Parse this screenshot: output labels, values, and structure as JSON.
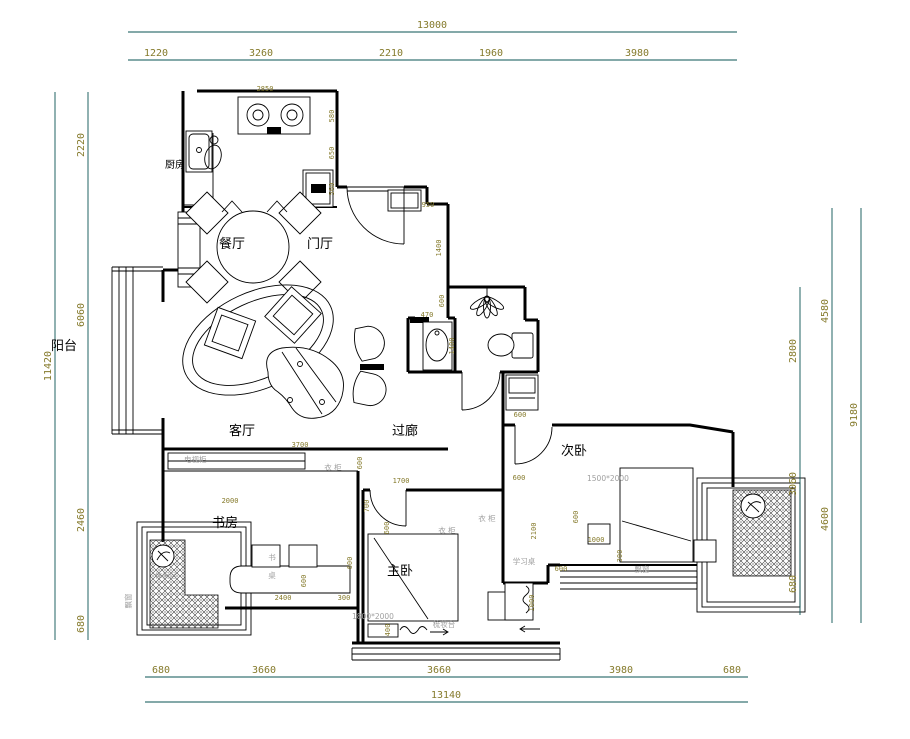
{
  "title": "apartment-floor-plan",
  "colors": {
    "wall": "#000000",
    "dim_line": "#0a5353",
    "dim_text": "#857a2b",
    "tick": "#dd0000",
    "fixture_text": "#a0a0a0"
  },
  "rooms": [
    {
      "label": "厨房"
    },
    {
      "label": "餐厅"
    },
    {
      "label": "门厅"
    },
    {
      "label": "阳台"
    },
    {
      "label": "客厅"
    },
    {
      "label": "过廊"
    },
    {
      "label": "书房"
    },
    {
      "label": "主卧"
    },
    {
      "label": "次卧"
    }
  ],
  "dims": {
    "top": {
      "total": "13000",
      "segments": [
        "1220",
        "3260",
        "2210",
        "1960",
        "3980"
      ]
    },
    "left": {
      "total": "11420",
      "segments": [
        "2220",
        "6060",
        "2460",
        "680"
      ]
    },
    "right": {
      "total": "9180",
      "mid_segments": [
        "4580",
        "4600"
      ],
      "inner_segments": [
        "2800",
        "3060",
        "680"
      ]
    },
    "bottom": {
      "total": "13140",
      "segments": [
        "680",
        "3660",
        "3660",
        "3980",
        "680"
      ]
    }
  },
  "int_dims": [
    "2850",
    "580",
    "650",
    "560",
    "950",
    "1400",
    "600",
    "470",
    "1400",
    "600",
    "3700",
    "600",
    "1700",
    "700",
    "2000",
    "600",
    "2400",
    "300",
    "600",
    "600",
    "400",
    "600",
    "2100",
    "600",
    "1000",
    "300",
    "600",
    "1000"
  ],
  "fixtures": [
    {
      "label": "电视柜"
    },
    {
      "label": "衣 柜"
    },
    {
      "label": "衣 柜"
    },
    {
      "label": "衣 柜"
    },
    {
      "label": "书"
    },
    {
      "label": "桌"
    },
    {
      "label": "梳妆台"
    },
    {
      "label": "1800*2000"
    },
    {
      "label": "1500*2000"
    },
    {
      "label": "飘窗"
    },
    {
      "label": "飘窗"
    },
    {
      "label": "学习桌"
    },
    {
      "label": "休闲区"
    }
  ]
}
